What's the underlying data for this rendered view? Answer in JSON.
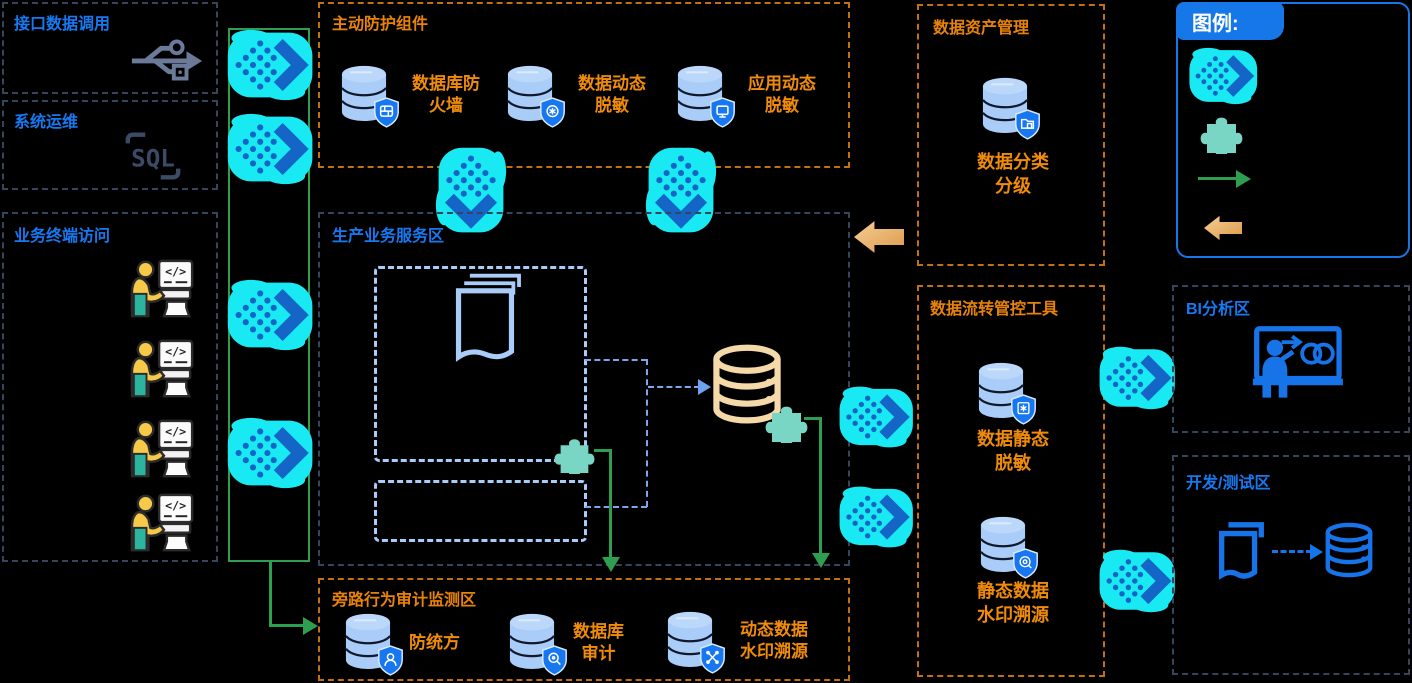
{
  "canvas": {
    "background": "#000000"
  },
  "colors": {
    "cyan_arrow": "#18E9F2",
    "chevron_blue": "#1565C6",
    "green_flow": "#2E9E50",
    "orange_border": "#C2710E",
    "orange_text": "#F08C0A",
    "blue_title": "#1779F2",
    "dark_border": "#36455E",
    "light_blue": "#A9CDF8",
    "tan_db": "#F6D9A8",
    "teal_puzzle": "#7AD6C4",
    "shield_blue": "#1677F0"
  },
  "zones": {
    "api_access": {
      "title": "接口数据调用",
      "icon": "usb-icon"
    },
    "system_ops": {
      "title": "系统运维",
      "icon": "sql-icon"
    },
    "terminal_access": {
      "title": "业务终端访问",
      "icon": "terminal-user-icon",
      "terminal_count": 4
    },
    "active_protection": {
      "title": "主动防护组件",
      "items": [
        {
          "label": "数据库防\n火墙",
          "icon": "database-shield-firewall-icon"
        },
        {
          "label": "数据动态\n脱敏",
          "icon": "database-shield-refresh-icon"
        },
        {
          "label": "应用动态\n脱敏",
          "icon": "database-shield-screen-icon"
        }
      ]
    },
    "production": {
      "title": "生产业务服务区",
      "icons": [
        "documents-icon",
        "database-tan-icon",
        "plugin-puzzle-icon"
      ]
    },
    "audit": {
      "title": "旁路行为审计监测区",
      "items": [
        {
          "label": "防统方",
          "icon": "database-shield-person-icon"
        },
        {
          "label": "数据库\n审计",
          "icon": "database-shield-search-icon"
        },
        {
          "label": "动态数据\n水印溯源",
          "icon": "database-shield-trace-icon"
        }
      ]
    },
    "asset_mgmt": {
      "title": "数据资产管理",
      "items": [
        {
          "label": "数据分类\n分级",
          "icon": "database-shield-folder-icon"
        }
      ]
    },
    "flow_control": {
      "title": "数据流转管控工具",
      "items": [
        {
          "label": "数据静态\n脱敏",
          "icon": "database-shield-star-icon"
        },
        {
          "label": "静态数据\n水印溯源",
          "icon": "database-shield-watermark-icon"
        }
      ]
    },
    "bi": {
      "title": "BI分析区",
      "icon": "bi-presentation-icon"
    },
    "dev_test": {
      "title": "开发/测试区",
      "icons": [
        "document-icon",
        "database-outline-icon"
      ]
    },
    "legend": {
      "title": "图例:",
      "items": [
        {
          "icon": "data-flow-arrow-icon"
        },
        {
          "icon": "plugin-puzzle-icon"
        },
        {
          "icon": "green-flow-arrow-icon"
        },
        {
          "icon": "manage-flow-arrow-icon"
        }
      ]
    }
  }
}
